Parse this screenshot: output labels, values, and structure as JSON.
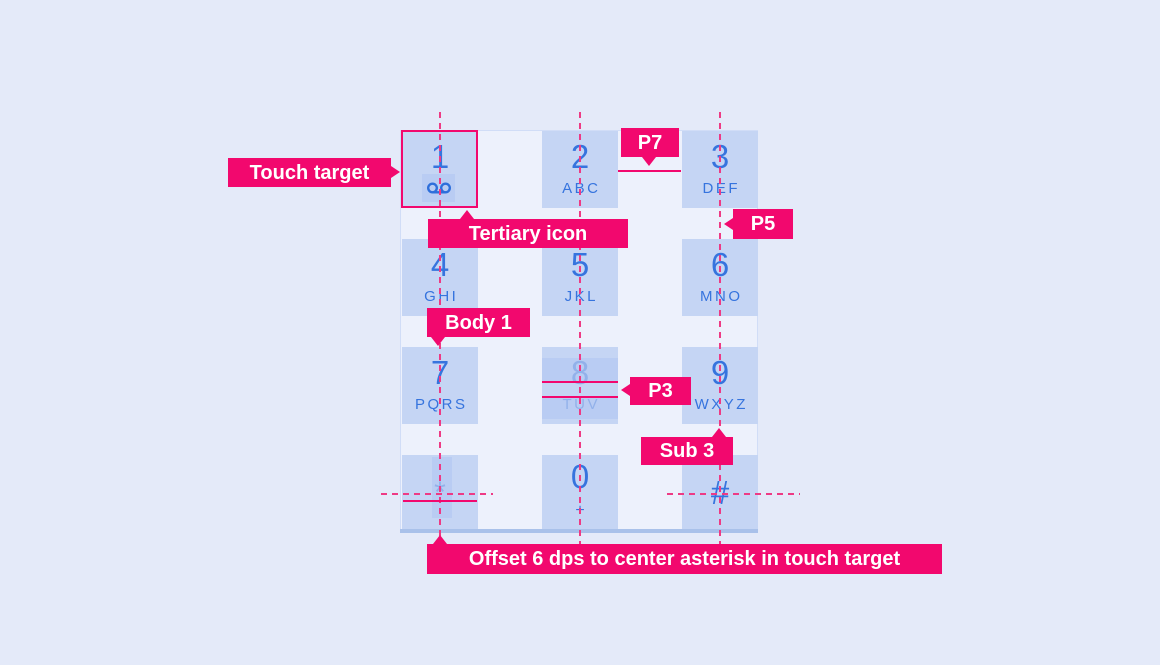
{
  "colors": {
    "accent": "#F2086E",
    "line_pink": "#EE3A85",
    "page_bg": "#E4EAF9",
    "panel_bg": "#EDF1FC",
    "key_bg": "#C5D5F4",
    "digit_blue": "#3674DE",
    "muted_blue": "#92B1EA",
    "icon_blue": "#2E6FDB"
  },
  "keypad": {
    "keys": [
      {
        "digit": "1",
        "letters": "",
        "icon": "voicemail-icon"
      },
      {
        "digit": "2",
        "letters": "ABC"
      },
      {
        "digit": "3",
        "letters": "DEF"
      },
      {
        "digit": "4",
        "letters": "GHI"
      },
      {
        "digit": "5",
        "letters": "JKL"
      },
      {
        "digit": "6",
        "letters": "MNO"
      },
      {
        "digit": "7",
        "letters": "PQRS"
      },
      {
        "digit": "8",
        "letters": "TUV"
      },
      {
        "digit": "9",
        "letters": "WXYZ"
      },
      {
        "digit": "*",
        "letters": ""
      },
      {
        "digit": "0",
        "letters": "+"
      },
      {
        "digit": "#",
        "letters": ""
      }
    ]
  },
  "annotations": {
    "touch_target": "Touch target",
    "tertiary_icon": "Tertiary icon",
    "p7": "P7",
    "p5": "P5",
    "body1": "Body 1",
    "p3": "P3",
    "sub3": "Sub 3",
    "offset": "Offset 6 dps to center asterisk in touch target"
  }
}
